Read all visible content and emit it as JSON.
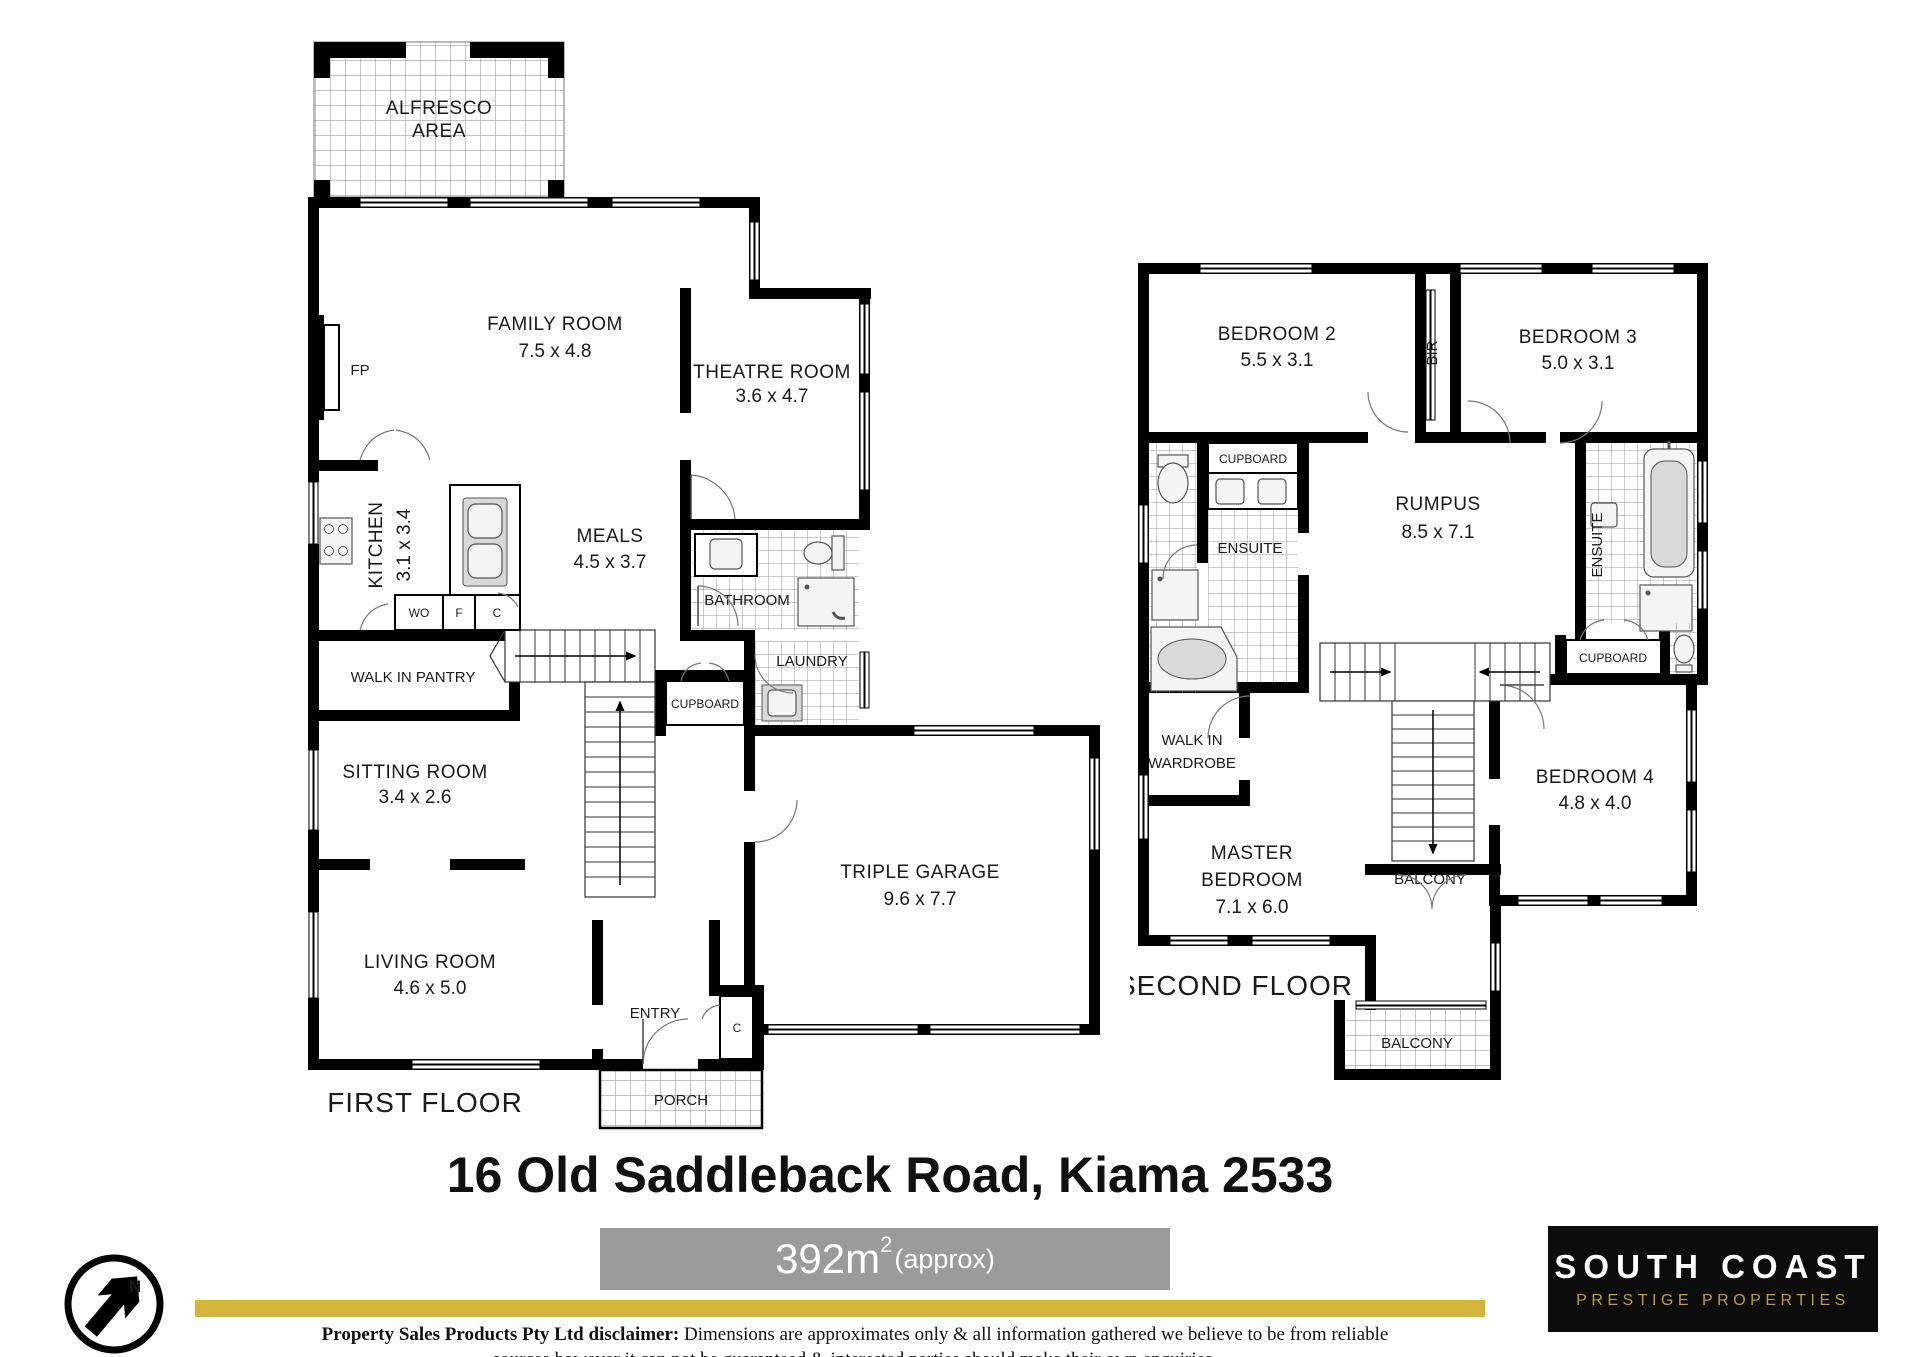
{
  "title": "16 Old Saddleback Road, Kiama 2533",
  "area_badge": {
    "value": "392m",
    "superscript": "2",
    "approx": "(approx)"
  },
  "north_arrow": {
    "label": "N"
  },
  "logo": {
    "line1": "SOUTH COAST",
    "line2": "PRESTIGE PROPERTIES"
  },
  "disclaimer": {
    "lead": "Property Sales Products Pty Ltd disclaimer:",
    "line1": " Dimensions are approximates only & all information gathered we believe to be from reliable",
    "line2": "sources however it can not be guaranteed & interested parties should make their own enquiries."
  },
  "colors": {
    "wall": "#000000",
    "area_bar": "#9b9b9b",
    "gold_divider": "#d2b33c",
    "logo_background": "#0c0c0c",
    "logo_gold": "#c19a3f",
    "tile_line": "#999999"
  },
  "first_floor": {
    "label": "FIRST FLOOR",
    "rooms": {
      "alfresco": {
        "line1": "ALFRESCO",
        "line2": "AREA"
      },
      "fp": "FP",
      "family": {
        "name": "FAMILY ROOM",
        "dim": "7.5 x 4.8"
      },
      "theatre": {
        "name": "THEATRE ROOM",
        "dim": "3.6 x 4.7"
      },
      "kitchen": {
        "name": "KITCHEN",
        "dim": "3.1 x 3.4"
      },
      "meals": {
        "name": "MEALS",
        "dim": "4.5 x 3.7"
      },
      "bathroom": {
        "name": "BATHROOM"
      },
      "laundry": {
        "name": "LAUNDRY"
      },
      "cupboard": {
        "name": "CUPBOARD"
      },
      "wo": "WO",
      "f": "F",
      "c": "C",
      "pantry": {
        "name": "WALK IN PANTRY"
      },
      "sitting": {
        "name": "SITTING ROOM",
        "dim": "3.4 x 2.6"
      },
      "living": {
        "name": "LIVING ROOM",
        "dim": "4.6 x 5.0"
      },
      "entry": {
        "name": "ENTRY"
      },
      "entry_c": "C",
      "porch": {
        "name": "PORCH"
      },
      "garage": {
        "name": "TRIPLE GARAGE",
        "dim": "9.6 x 7.7"
      }
    }
  },
  "second_floor": {
    "label": "SECOND FLOOR",
    "rooms": {
      "bedroom2": {
        "name": "BEDROOM 2",
        "dim": "5.5 x 3.1"
      },
      "bir": "BIR",
      "bedroom3": {
        "name": "BEDROOM 3",
        "dim": "5.0 x 3.1"
      },
      "cupboard_left": "CUPBOARD",
      "ensuite_left": "ENSUITE",
      "rumpus": {
        "name": "RUMPUS",
        "dim": "8.5 x 7.1"
      },
      "ensuite_right": "ENSUITE",
      "cupboard_right": "CUPBOARD",
      "wiw": {
        "line1": "WALK IN",
        "line2": "WARDROBE"
      },
      "master": {
        "line1": "MASTER",
        "line2": "BEDROOM",
        "dim": "7.1 x 6.0"
      },
      "bedroom4": {
        "name": "BEDROOM 4",
        "dim": "4.8 x 4.0"
      },
      "balcony_mid": "BALCONY",
      "balcony_bottom": "BALCONY"
    }
  }
}
